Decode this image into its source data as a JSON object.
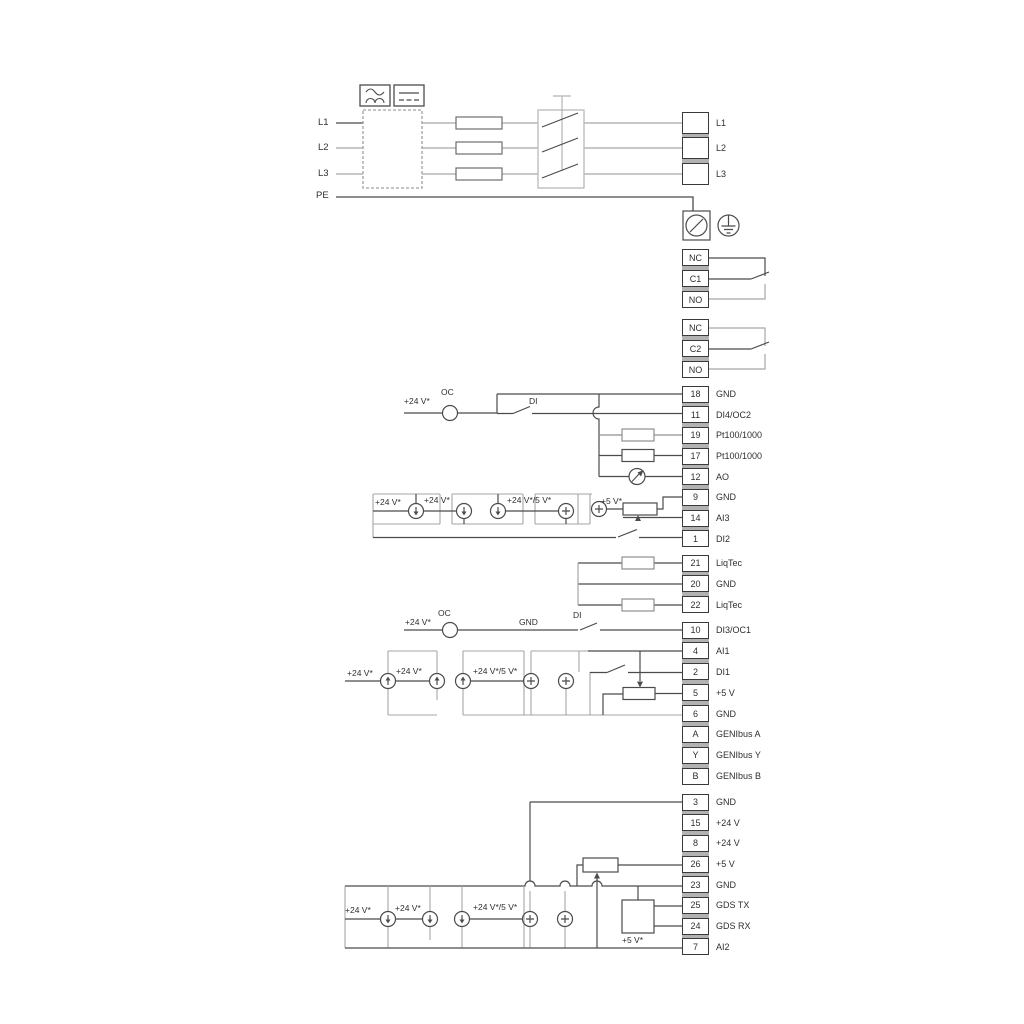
{
  "ann": {
    "v24": "+24 V*",
    "v24_5": "+24 V*/5 V*",
    "v5s": "+5 V*",
    "oc": "OC",
    "di": "DI",
    "gnd": "GND"
  },
  "power": {
    "inputs": [
      "L1",
      "L2",
      "L3",
      "PE"
    ]
  },
  "groups": {
    "power_out": [
      {
        "num": "",
        "label": "L1"
      },
      {
        "num": "",
        "label": "L2"
      },
      {
        "num": "",
        "label": "L3"
      }
    ],
    "relay1": [
      {
        "num": "NC",
        "label": ""
      },
      {
        "num": "C1",
        "label": ""
      },
      {
        "num": "NO",
        "label": ""
      }
    ],
    "relay2": [
      {
        "num": "NC",
        "label": ""
      },
      {
        "num": "C2",
        "label": ""
      },
      {
        "num": "NO",
        "label": ""
      }
    ],
    "io1": [
      {
        "num": "18",
        "label": "GND"
      },
      {
        "num": "11",
        "label": "DI4/OC2"
      },
      {
        "num": "19",
        "label": "Pt100/1000"
      },
      {
        "num": "17",
        "label": "Pt100/1000"
      },
      {
        "num": "12",
        "label": "AO"
      },
      {
        "num": "9",
        "label": "GND"
      },
      {
        "num": "14",
        "label": "AI3"
      },
      {
        "num": "1",
        "label": "DI2"
      }
    ],
    "liqtec": [
      {
        "num": "21",
        "label": "LiqTec"
      },
      {
        "num": "20",
        "label": "GND"
      },
      {
        "num": "22",
        "label": "LiqTec"
      }
    ],
    "io2": [
      {
        "num": "10",
        "label": "DI3/OC1"
      },
      {
        "num": "4",
        "label": "AI1"
      },
      {
        "num": "2",
        "label": "DI1"
      },
      {
        "num": "5",
        "label": "+5 V"
      },
      {
        "num": "6",
        "label": "GND"
      },
      {
        "num": "A",
        "label": "GENIbus A"
      },
      {
        "num": "Y",
        "label": "GENIbus Y"
      },
      {
        "num": "B",
        "label": "GENIbus B"
      }
    ],
    "io3": [
      {
        "num": "3",
        "label": "GND"
      },
      {
        "num": "15",
        "label": "+24 V"
      },
      {
        "num": "8",
        "label": "+24 V"
      },
      {
        "num": "26",
        "label": "+5 V"
      },
      {
        "num": "23",
        "label": "GND"
      },
      {
        "num": "25",
        "label": "GDS TX"
      },
      {
        "num": "24",
        "label": "GDS RX"
      },
      {
        "num": "7",
        "label": "AI2"
      }
    ]
  }
}
